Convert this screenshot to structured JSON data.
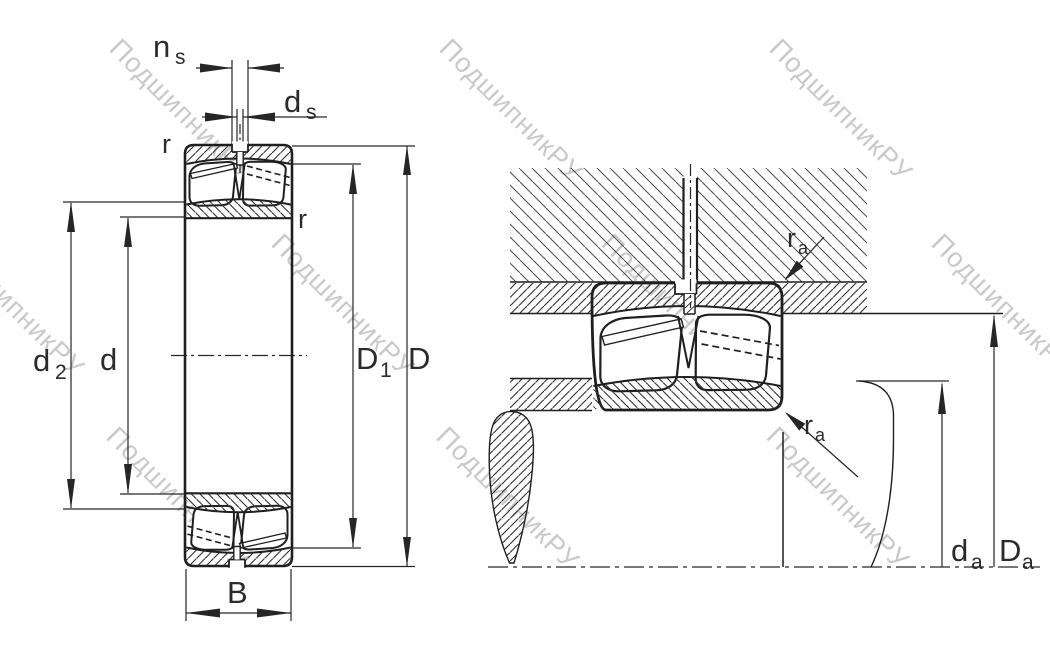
{
  "drawing": {
    "description": "Spherical roller bearing dimension drawing: cross-section view and mounted abutment view",
    "watermark": "ПодшипникРУ"
  },
  "labels": {
    "ns_base": "n",
    "ns_sub": "s",
    "ds_base": "d",
    "ds_sub": "s",
    "r_left": "r",
    "r_right": "r",
    "d2_base": "d",
    "d2_sub": "2",
    "d": "d",
    "D1_base": "D",
    "D1_sub": "1",
    "D": "D",
    "B": "B",
    "ra_top_base": "r",
    "ra_top_sub": "a",
    "ra_bot_base": "r",
    "ra_bot_sub": "a",
    "da_base": "d",
    "da_sub": "a",
    "Da_base": "D",
    "Da_sub": "a"
  },
  "colors": {
    "line": "#1f1f1f",
    "dim": "#262626",
    "label": "#2b2b2b",
    "hatch": "#2f2f2f",
    "hatch_wide": "#4a4a4a",
    "watermark": "#c9c9c9",
    "background": "#ffffff"
  }
}
